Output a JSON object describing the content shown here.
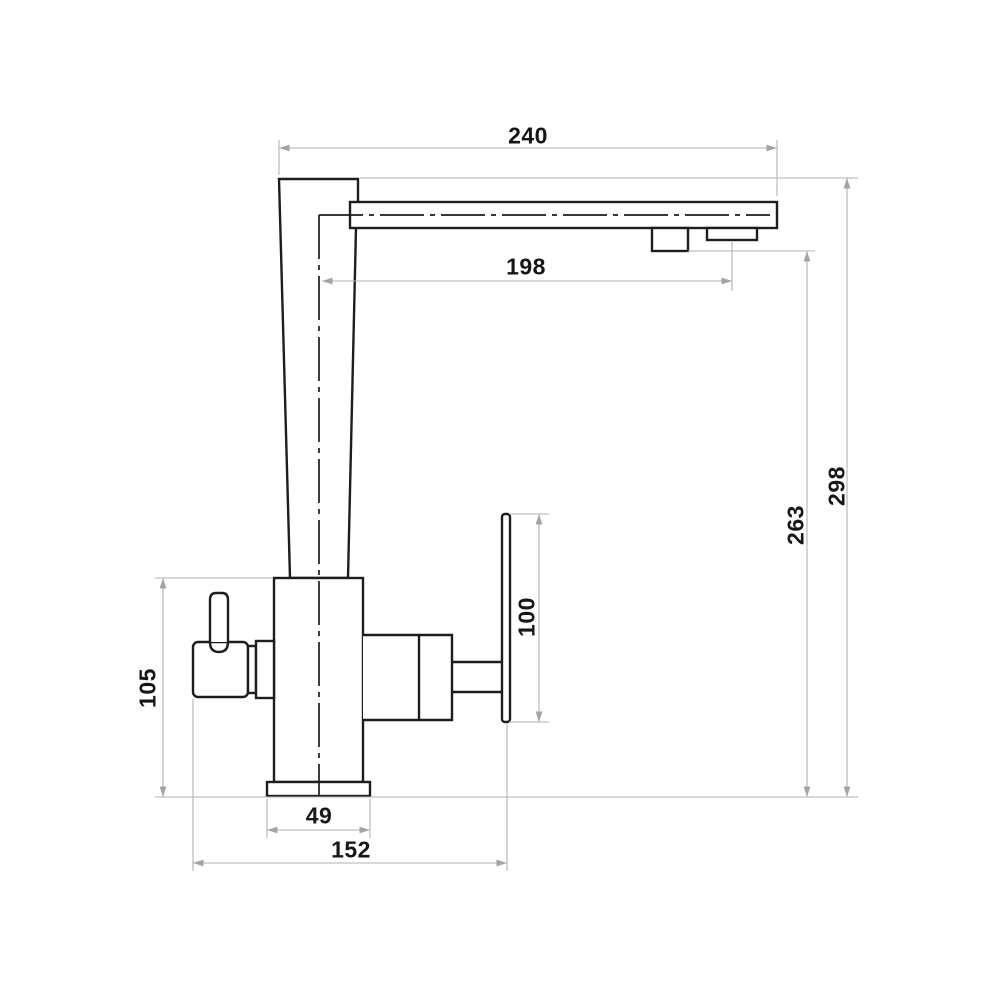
{
  "drawing": {
    "background": "#ffffff",
    "colors": {
      "outline": "#1d1d1d",
      "dimension_line": "#b2b2b2",
      "arrow": "#a4a4a4",
      "label_text": "#171717"
    },
    "dimensions": {
      "spout_length": {
        "value": "240",
        "orientation": "horizontal"
      },
      "spout_reach": {
        "value": "198",
        "orientation": "horizontal"
      },
      "overall_height": {
        "value": "298",
        "orientation": "vertical"
      },
      "aerator_height": {
        "value": "263",
        "orientation": "vertical"
      },
      "handle_plate_height": {
        "value": "100",
        "orientation": "vertical"
      },
      "body_height": {
        "value": "105",
        "orientation": "vertical"
      },
      "base_width": {
        "value": "49",
        "orientation": "horizontal"
      },
      "overall_width": {
        "value": "152",
        "orientation": "horizontal"
      }
    }
  }
}
